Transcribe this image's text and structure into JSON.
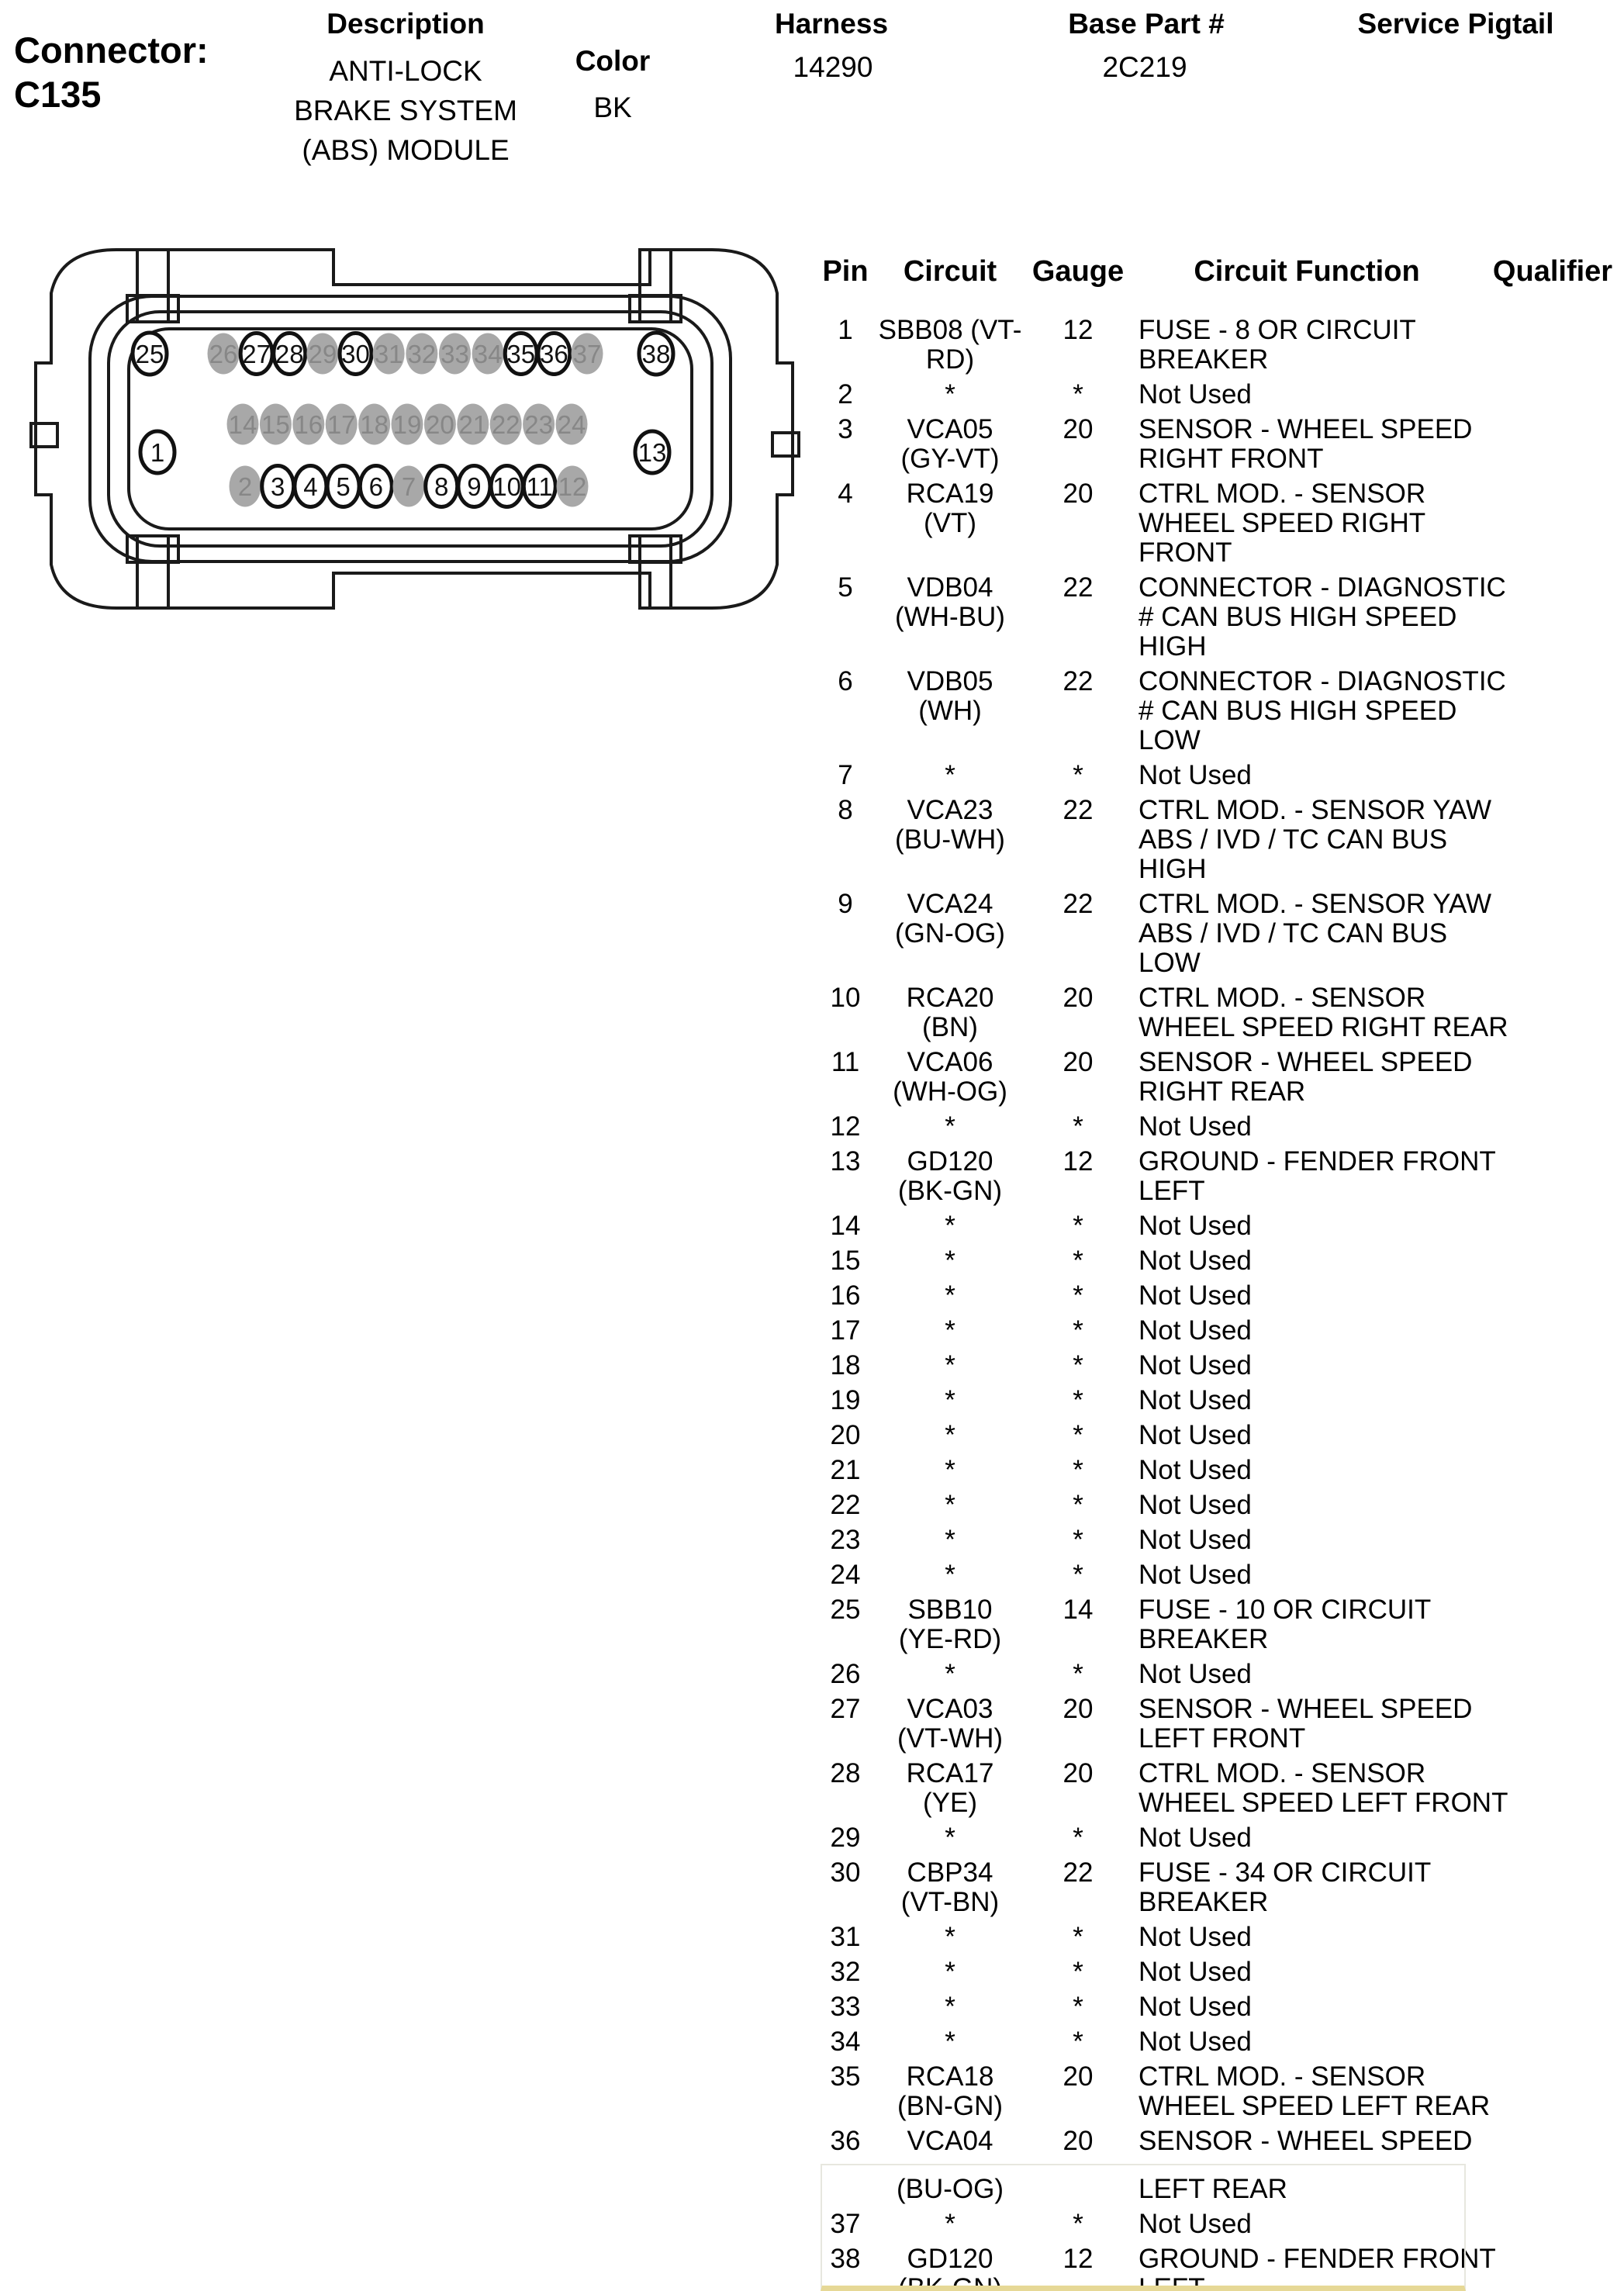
{
  "header": {
    "connector_label": "Connector:",
    "connector_id": "C135",
    "description_label": "Description",
    "description_lines": [
      "ANTI-LOCK",
      "BRAKE SYSTEM",
      "(ABS) MODULE"
    ],
    "color_label": "Color",
    "color_value": "BK",
    "harness_label": "Harness",
    "harness_value": "14290",
    "base_part_label": "Base Part #",
    "base_part_value": "2C219",
    "service_pigtail_label": "Service Pigtail",
    "service_pigtail_value": ""
  },
  "connector_diagram": {
    "colors": {
      "line": "#1a1a1a",
      "used_pin_fill": "#ffffff",
      "used_pin_stroke": "#111111",
      "used_pin_text": "#111111",
      "unused_pin_fill": "#a8a8a8",
      "unused_pin_text": "#878787"
    },
    "singles": [
      {
        "n": "25",
        "pos": "top-left",
        "used": true
      },
      {
        "n": "38",
        "pos": "top-right",
        "used": true
      },
      {
        "n": "1",
        "pos": "mid-left",
        "used": true
      },
      {
        "n": "13",
        "pos": "mid-right",
        "used": true
      }
    ],
    "top_row": [
      {
        "n": "26",
        "used": false
      },
      {
        "n": "27",
        "used": true
      },
      {
        "n": "28",
        "used": true
      },
      {
        "n": "29",
        "used": false
      },
      {
        "n": "30",
        "used": true
      },
      {
        "n": "31",
        "used": false
      },
      {
        "n": "32",
        "used": false
      },
      {
        "n": "33",
        "used": false
      },
      {
        "n": "34",
        "used": false
      },
      {
        "n": "35",
        "used": true
      },
      {
        "n": "36",
        "used": true
      },
      {
        "n": "37",
        "used": false
      }
    ],
    "middle_row": [
      {
        "n": "14",
        "used": false
      },
      {
        "n": "15",
        "used": false
      },
      {
        "n": "16",
        "used": false
      },
      {
        "n": "17",
        "used": false
      },
      {
        "n": "18",
        "used": false
      },
      {
        "n": "19",
        "used": false
      },
      {
        "n": "20",
        "used": false
      },
      {
        "n": "21",
        "used": false
      },
      {
        "n": "22",
        "used": false
      },
      {
        "n": "23",
        "used": false
      },
      {
        "n": "24",
        "used": false
      }
    ],
    "bottom_row": [
      {
        "n": "2",
        "used": false
      },
      {
        "n": "3",
        "used": true
      },
      {
        "n": "4",
        "used": true
      },
      {
        "n": "5",
        "used": true
      },
      {
        "n": "6",
        "used": true
      },
      {
        "n": "7",
        "used": false
      },
      {
        "n": "8",
        "used": true
      },
      {
        "n": "9",
        "used": true
      },
      {
        "n": "10",
        "used": true
      },
      {
        "n": "11",
        "used": true
      },
      {
        "n": "12",
        "used": false
      }
    ]
  },
  "table": {
    "columns": [
      "Pin",
      "Circuit",
      "Gauge",
      "Circuit Function",
      "Qualifier"
    ],
    "rows": [
      {
        "pin": "1",
        "circuit": [
          "SBB08 (VT-",
          "RD)"
        ],
        "gauge": "12",
        "function": [
          "FUSE - 8 OR CIRCUIT",
          "BREAKER"
        ],
        "qualifier": ""
      },
      {
        "pin": "2",
        "circuit": [
          "*"
        ],
        "gauge": "*",
        "function": [
          "Not Used"
        ],
        "qualifier": ""
      },
      {
        "pin": "3",
        "circuit": [
          "VCA05",
          "(GY-VT)"
        ],
        "gauge": "20",
        "function": [
          "SENSOR - WHEEL SPEED",
          "RIGHT FRONT"
        ],
        "qualifier": ""
      },
      {
        "pin": "4",
        "circuit": [
          "RCA19",
          "(VT)"
        ],
        "gauge": "20",
        "function": [
          "CTRL MOD. - SENSOR",
          "WHEEL SPEED RIGHT",
          "FRONT"
        ],
        "qualifier": ""
      },
      {
        "pin": "5",
        "circuit": [
          "VDB04",
          "(WH-BU)"
        ],
        "gauge": "22",
        "function": [
          "CONNECTOR - DIAGNOSTIC",
          "# CAN BUS HIGH SPEED",
          "HIGH"
        ],
        "qualifier": ""
      },
      {
        "pin": "6",
        "circuit": [
          "VDB05",
          "(WH)"
        ],
        "gauge": "22",
        "function": [
          "CONNECTOR - DIAGNOSTIC",
          "# CAN BUS HIGH SPEED",
          "LOW"
        ],
        "qualifier": ""
      },
      {
        "pin": "7",
        "circuit": [
          "*"
        ],
        "gauge": "*",
        "function": [
          "Not Used"
        ],
        "qualifier": ""
      },
      {
        "pin": "8",
        "circuit": [
          "VCA23",
          "(BU-WH)"
        ],
        "gauge": "22",
        "function": [
          "CTRL MOD. - SENSOR YAW",
          "ABS / IVD / TC CAN BUS",
          "HIGH"
        ],
        "qualifier": ""
      },
      {
        "pin": "9",
        "circuit": [
          "VCA24",
          "(GN-OG)"
        ],
        "gauge": "22",
        "function": [
          "CTRL MOD. - SENSOR YAW",
          "ABS / IVD / TC CAN BUS",
          "LOW"
        ],
        "qualifier": ""
      },
      {
        "pin": "10",
        "circuit": [
          "RCA20",
          "(BN)"
        ],
        "gauge": "20",
        "function": [
          "CTRL MOD. - SENSOR",
          "WHEEL SPEED RIGHT REAR"
        ],
        "qualifier": ""
      },
      {
        "pin": "11",
        "circuit": [
          "VCA06",
          "(WH-OG)"
        ],
        "gauge": "20",
        "function": [
          "SENSOR - WHEEL SPEED",
          "RIGHT REAR"
        ],
        "qualifier": ""
      },
      {
        "pin": "12",
        "circuit": [
          "*"
        ],
        "gauge": "*",
        "function": [
          "Not Used"
        ],
        "qualifier": ""
      },
      {
        "pin": "13",
        "circuit": [
          "GD120",
          "(BK-GN)"
        ],
        "gauge": "12",
        "function": [
          "GROUND - FENDER FRONT",
          "LEFT"
        ],
        "qualifier": ""
      },
      {
        "pin": "14",
        "circuit": [
          "*"
        ],
        "gauge": "*",
        "function": [
          "Not Used"
        ],
        "qualifier": ""
      },
      {
        "pin": "15",
        "circuit": [
          "*"
        ],
        "gauge": "*",
        "function": [
          "Not Used"
        ],
        "qualifier": ""
      },
      {
        "pin": "16",
        "circuit": [
          "*"
        ],
        "gauge": "*",
        "function": [
          "Not Used"
        ],
        "qualifier": ""
      },
      {
        "pin": "17",
        "circuit": [
          "*"
        ],
        "gauge": "*",
        "function": [
          "Not Used"
        ],
        "qualifier": ""
      },
      {
        "pin": "18",
        "circuit": [
          "*"
        ],
        "gauge": "*",
        "function": [
          "Not Used"
        ],
        "qualifier": ""
      },
      {
        "pin": "19",
        "circuit": [
          "*"
        ],
        "gauge": "*",
        "function": [
          "Not Used"
        ],
        "qualifier": ""
      },
      {
        "pin": "20",
        "circuit": [
          "*"
        ],
        "gauge": "*",
        "function": [
          "Not Used"
        ],
        "qualifier": ""
      },
      {
        "pin": "21",
        "circuit": [
          "*"
        ],
        "gauge": "*",
        "function": [
          "Not Used"
        ],
        "qualifier": ""
      },
      {
        "pin": "22",
        "circuit": [
          "*"
        ],
        "gauge": "*",
        "function": [
          "Not Used"
        ],
        "qualifier": ""
      },
      {
        "pin": "23",
        "circuit": [
          "*"
        ],
        "gauge": "*",
        "function": [
          "Not Used"
        ],
        "qualifier": ""
      },
      {
        "pin": "24",
        "circuit": [
          "*"
        ],
        "gauge": "*",
        "function": [
          "Not Used"
        ],
        "qualifier": ""
      },
      {
        "pin": "25",
        "circuit": [
          "SBB10",
          "(YE-RD)"
        ],
        "gauge": "14",
        "function": [
          "FUSE - 10 OR CIRCUIT",
          "BREAKER"
        ],
        "qualifier": ""
      },
      {
        "pin": "26",
        "circuit": [
          "*"
        ],
        "gauge": "*",
        "function": [
          "Not Used"
        ],
        "qualifier": ""
      },
      {
        "pin": "27",
        "circuit": [
          "VCA03",
          "(VT-WH)"
        ],
        "gauge": "20",
        "function": [
          "SENSOR - WHEEL SPEED",
          "LEFT FRONT"
        ],
        "qualifier": ""
      },
      {
        "pin": "28",
        "circuit": [
          "RCA17",
          "(YE)"
        ],
        "gauge": "20",
        "function": [
          "CTRL MOD. - SENSOR",
          "WHEEL SPEED LEFT FRONT"
        ],
        "qualifier": ""
      },
      {
        "pin": "29",
        "circuit": [
          "*"
        ],
        "gauge": "*",
        "function": [
          "Not Used"
        ],
        "qualifier": ""
      },
      {
        "pin": "30",
        "circuit": [
          "CBP34",
          "(VT-BN)"
        ],
        "gauge": "22",
        "function": [
          "FUSE - 34 OR CIRCUIT",
          "BREAKER"
        ],
        "qualifier": ""
      },
      {
        "pin": "31",
        "circuit": [
          "*"
        ],
        "gauge": "*",
        "function": [
          "Not Used"
        ],
        "qualifier": ""
      },
      {
        "pin": "32",
        "circuit": [
          "*"
        ],
        "gauge": "*",
        "function": [
          "Not Used"
        ],
        "qualifier": ""
      },
      {
        "pin": "33",
        "circuit": [
          "*"
        ],
        "gauge": "*",
        "function": [
          "Not Used"
        ],
        "qualifier": ""
      },
      {
        "pin": "34",
        "circuit": [
          "*"
        ],
        "gauge": "*",
        "function": [
          "Not Used"
        ],
        "qualifier": ""
      },
      {
        "pin": "35",
        "circuit": [
          "RCA18",
          "(BN-GN)"
        ],
        "gauge": "20",
        "function": [
          "CTRL MOD. - SENSOR",
          "WHEEL SPEED LEFT REAR"
        ],
        "qualifier": ""
      },
      {
        "pin": "36",
        "circuit": [
          "VCA04",
          "(BU-OG)"
        ],
        "gauge": "20",
        "function": [
          "SENSOR - WHEEL SPEED",
          "LEFT REAR"
        ],
        "qualifier": "",
        "split_gap": true
      },
      {
        "pin": "37",
        "circuit": [
          "*"
        ],
        "gauge": "*",
        "function": [
          "Not Used"
        ],
        "qualifier": ""
      },
      {
        "pin": "38",
        "circuit": [
          "GD120",
          "(BK-GN)"
        ],
        "gauge": "12",
        "function": [
          "GROUND - FENDER FRONT",
          "LEFT"
        ],
        "qualifier": ""
      }
    ]
  },
  "highlight_box": {
    "border_color": "#e7e7df",
    "bottom_border_color": "#e6d896"
  }
}
